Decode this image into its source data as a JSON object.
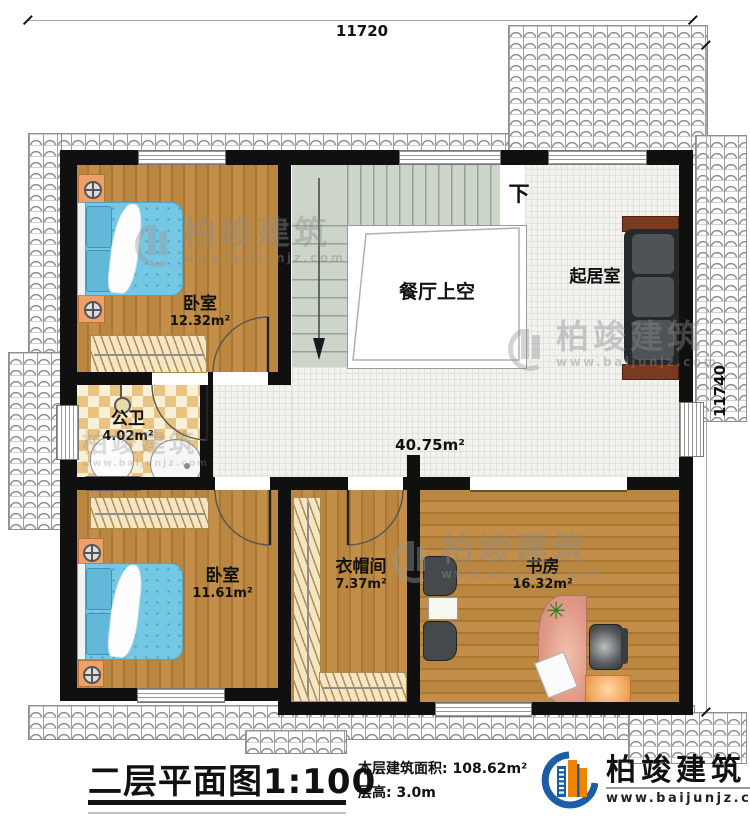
{
  "dimensions": {
    "top": "11720",
    "right": "11740"
  },
  "stairs": {
    "down_label": "下"
  },
  "rooms": {
    "bedroom1": {
      "name": "卧室",
      "area": "12.32m²"
    },
    "bedroom2": {
      "name": "卧室",
      "area": "11.61m²"
    },
    "bath": {
      "name": "公卫",
      "area": "4.02m²"
    },
    "hall": {
      "area": "40.75m²"
    },
    "void": {
      "name": "餐厅上空"
    },
    "living": {
      "name": "起居室"
    },
    "cloak": {
      "name": "衣帽间",
      "area": "7.37m²"
    },
    "study": {
      "name": "书房",
      "area": "16.32m²"
    }
  },
  "watermark": {
    "brand": "柏竣建筑",
    "url": "www.baijunjz.com"
  },
  "title": {
    "text": "二层平面图",
    "scale": "1:100"
  },
  "info": {
    "area_label": "本层建筑面积:",
    "area_value": "108.62m²",
    "floor_label": "层高:",
    "floor_value": "3.0m"
  },
  "brand": {
    "name": "柏竣建筑",
    "url": "www.baijunjz.com"
  },
  "colors": {
    "wall": "#101010",
    "accent_blue": "#1b5ea6",
    "accent_orange": "#f08300",
    "bed": "#74c8e4"
  }
}
